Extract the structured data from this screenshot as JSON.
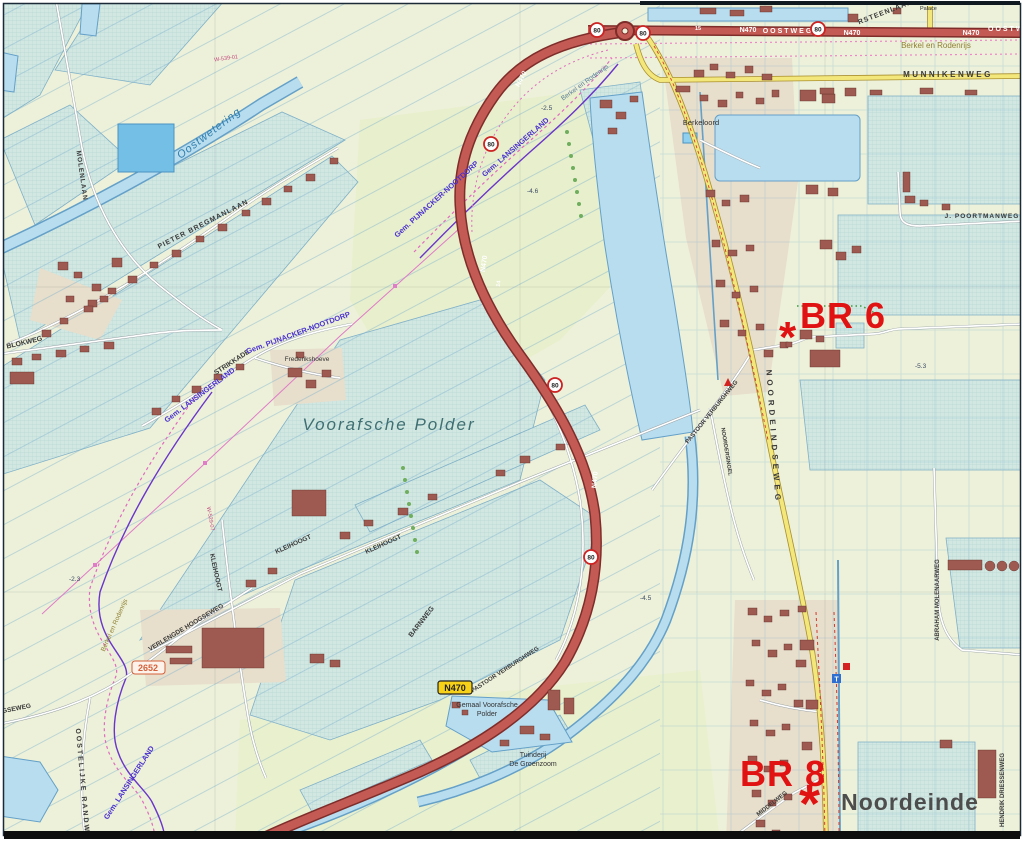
{
  "map": {
    "annotations": {
      "br6": "BR 6",
      "br8": "BR 8",
      "marker": "*"
    },
    "shields": {
      "n470": "N470",
      "speed_80": "80"
    },
    "road_markers": {
      "km15": "15",
      "km14": "14"
    },
    "roads": {
      "oostweg": "OOSTWEG",
      "munnikenweg": "MUNNIKENWEG",
      "noordeindseweg": "NOORDEINDSEWEG",
      "noordersingel": "NOORDERSINGEL",
      "pastoor_verburghweg": "PASTOOR VERBURGHWEG",
      "kleihoogt": "KLEIHOOGT",
      "verlengde_hoogseweg": "VERLENGDE HOOGSEWEG",
      "hoogseweg": "HOOGSEWEG",
      "barnweg": "BARNWEG",
      "blokweg": "BLOKWEG",
      "strikkade": "STRIKKADE",
      "pieter_bregmanlaan": "PIETER BREGMANLAAN",
      "molenlaan": "MOLENLAAN",
      "middelweg": "MIDDELWEG",
      "oostelijke_randweg": "OOSTELIJKE RANDWEG",
      "abraham_molenaarweg": "ABRAHAM MOLENAARWEG",
      "hendrik_driessenweg": "HENDRIK DRIESSENWEG",
      "j_poortmanweg": "J. POORTMANWEG",
      "rsteenlaan": "RSTEENLAAN"
    },
    "places": {
      "berkel_en_rodenrijs": "Berkel en Rodenrijs",
      "berkeloord": "Berkeloord",
      "noordeinde": "Noordeinde",
      "frederikshoeve": "Frederikshoeve",
      "palace": "Palace",
      "voorafsche_polder": "Voorafsche Polder",
      "gemaal_line1": "Gemaal Voorafsche",
      "gemaal_line2": "Polder",
      "tuinderij_line1": "Tuinderij",
      "tuinderij_line2": "De Groenzoom"
    },
    "boundaries": {
      "gem_lansingerland": "Gem. LANSINGERLAND",
      "gem_pijnacker_nootdorp": "Gem. PIJNACKER-NOOTDORP"
    },
    "water_labels": {
      "oostwetering": "Oostwetering",
      "berkel_canal": "Berkel en Rodenrijs"
    },
    "depths": {
      "d25": "-2.5",
      "d46": "-4.6",
      "d45": "-4.5",
      "d53": "-5.3",
      "d23": "-2.3"
    },
    "codes": {
      "w539": "W-539-01",
      "w529": "W-529-07",
      "area2652": "2652"
    },
    "colors": {
      "annotation_red": "#e01212",
      "n470_road": "#c45a54",
      "yellow_road": "#f3e77c",
      "water": "#b8ddef",
      "boundary_purple": "#4a30cf",
      "teal_parcel": "#d2e7e2"
    }
  }
}
